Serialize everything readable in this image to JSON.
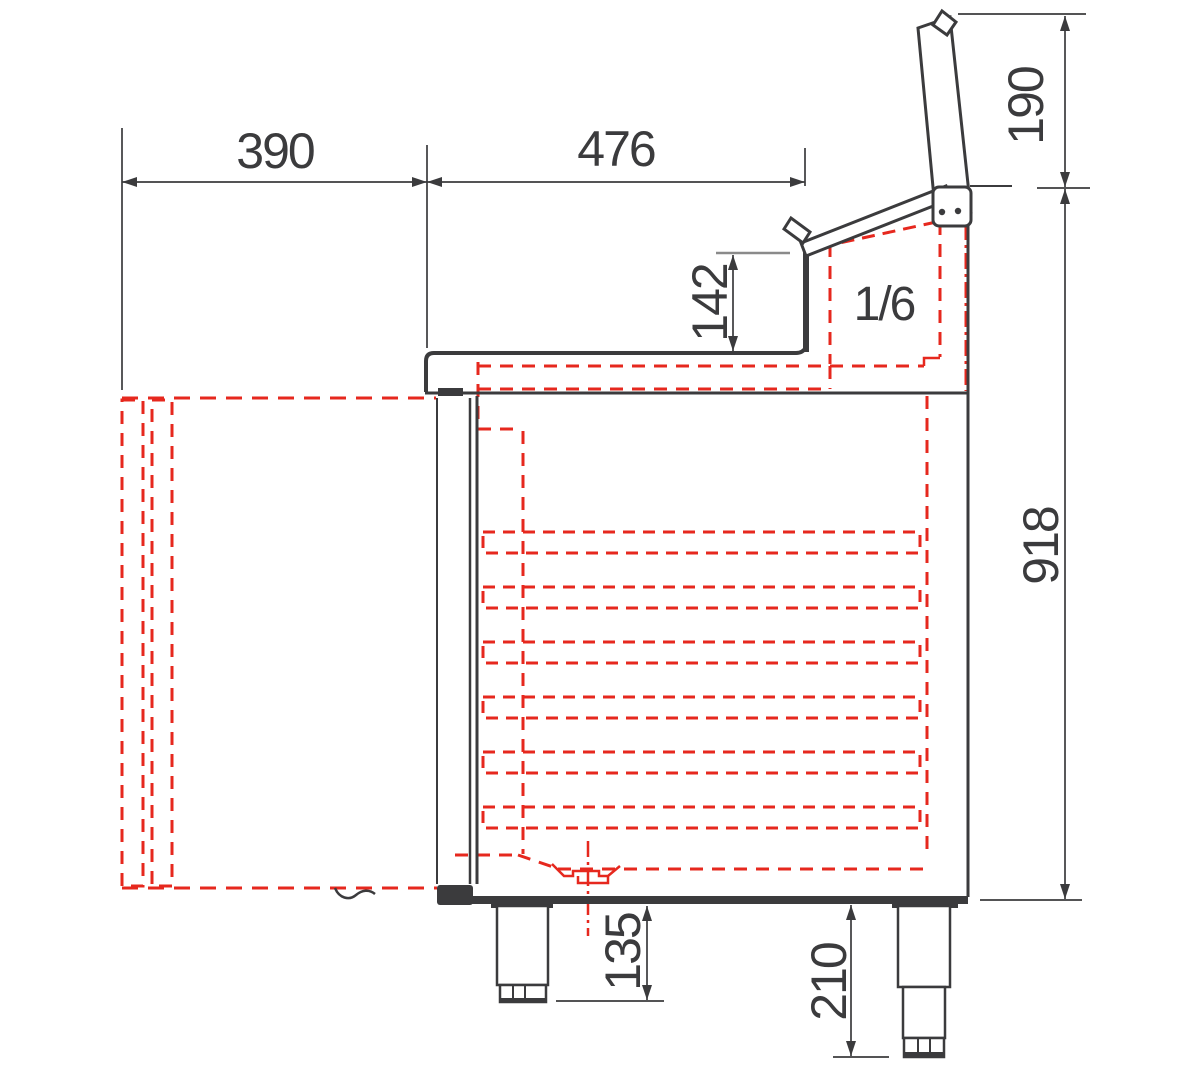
{
  "title": "Refrigerated saladette counter - side section technical drawing",
  "colors": {
    "line": "#3b3b3d",
    "hidden_red": "#e6281e",
    "tick_gray": "#8a8a8a",
    "background": "#ffffff"
  },
  "labels": {
    "gn_container": "1/6"
  },
  "dimensions": {
    "door_open_depth": "390",
    "worktop_depth": "476",
    "open_lid_height": "190",
    "well_raise_height": "142",
    "overall_height": "918",
    "front_foot_height": "135",
    "rear_foot_height": "210"
  }
}
